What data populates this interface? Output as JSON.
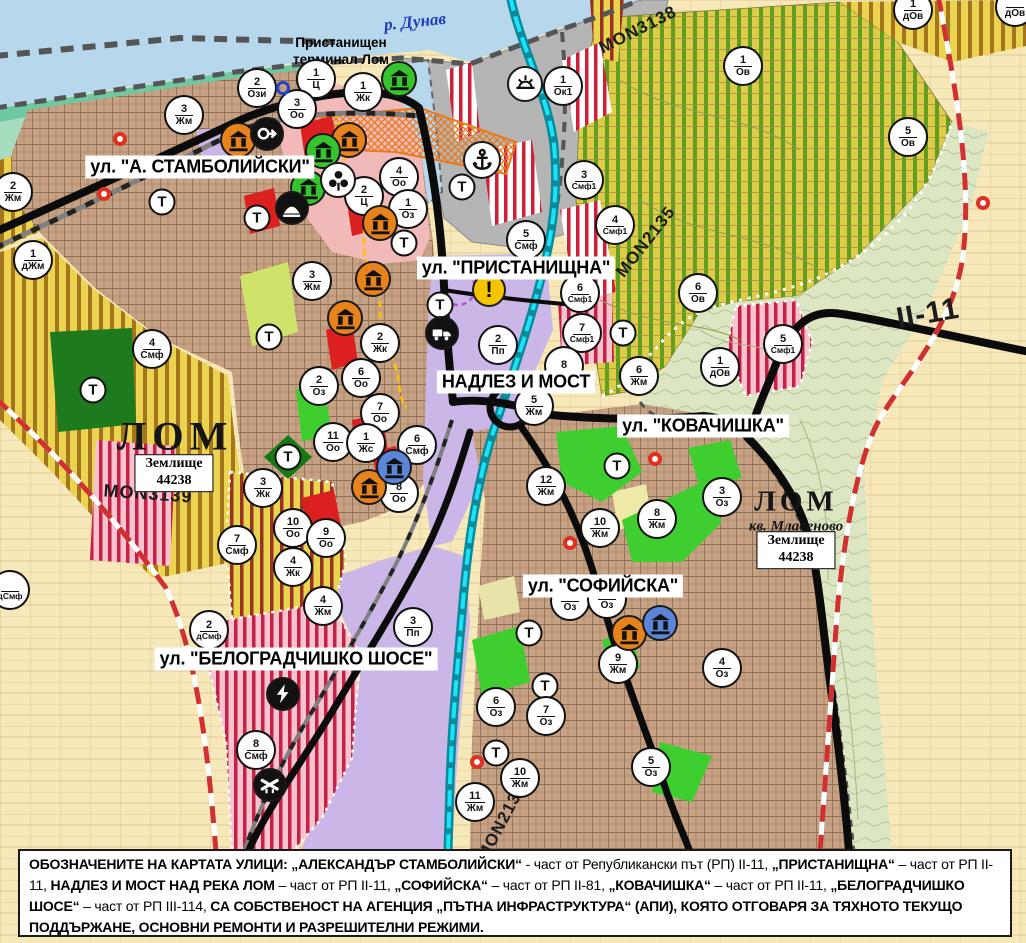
{
  "map": {
    "street_labels": [
      {
        "text": "ул. \"А. СТАМБОЛИЙСКИ\"",
        "x": 200,
        "y": 167
      },
      {
        "text": "ул. \"ПРИСТАНИЩНА\"",
        "x": 516,
        "y": 268
      },
      {
        "text": "НАДЛЕЗ И МОСТ",
        "x": 516,
        "y": 382
      },
      {
        "text": "ул. \"КОВАЧИШКА\"",
        "x": 703,
        "y": 426
      },
      {
        "text": "ул. \"СОФИЙСКА\"",
        "x": 603,
        "y": 586
      },
      {
        "text": "ул. \"БЕЛОГРАДЧИШКО ШОСЕ\"",
        "x": 296,
        "y": 659
      }
    ],
    "river_label": {
      "text": "р. Дунав",
      "x": 415,
      "y": 22,
      "rot": -6
    },
    "terminal_label": {
      "text": "Пристанищен\nтерминал Лом",
      "x": 341,
      "y": 52
    },
    "town_labels": [
      {
        "text": "ЛОМ",
        "x": 175,
        "y": 436,
        "cls": "town-label-lg"
      },
      {
        "text": "ЛОМ",
        "x": 796,
        "y": 502,
        "cls": "town-label-md"
      },
      {
        "text": "кв. Младеново",
        "x": 796,
        "y": 527,
        "cls": "quarter-label"
      }
    ],
    "land_boxes": [
      {
        "line1": "Землище",
        "line2": "44238",
        "x": 174,
        "y": 473
      },
      {
        "line1": "Землище",
        "line2": "44238",
        "x": 796,
        "y": 550
      }
    ],
    "road_labels": [
      {
        "text": "MON3138",
        "x": 638,
        "y": 30,
        "rot": -27,
        "size": 17
      },
      {
        "text": "MON2135",
        "x": 646,
        "y": 242,
        "rot": -52,
        "size": 17
      },
      {
        "text": "II-11",
        "x": 928,
        "y": 314,
        "rot": -10,
        "size": 30
      },
      {
        "text": "MON3139",
        "x": 148,
        "y": 494,
        "rot": 4,
        "size": 18
      },
      {
        "text": "MON2136",
        "x": 502,
        "y": 822,
        "rot": -62,
        "size": 17
      }
    ],
    "t_label": "Т",
    "t_markers": [
      {
        "x": 162,
        "y": 202
      },
      {
        "x": 257,
        "y": 218
      },
      {
        "x": 404,
        "y": 243
      },
      {
        "x": 462,
        "y": 187
      },
      {
        "x": 269,
        "y": 337
      },
      {
        "x": 440,
        "y": 305
      },
      {
        "x": 623,
        "y": 333
      },
      {
        "x": 288,
        "y": 457
      },
      {
        "x": 93,
        "y": 390
      },
      {
        "x": 617,
        "y": 466
      },
      {
        "x": 529,
        "y": 633
      },
      {
        "x": 545,
        "y": 686
      },
      {
        "x": 496,
        "y": 753
      }
    ],
    "zone_markers": [
      {
        "n": "2",
        "c": "Ози",
        "x": 257,
        "y": 88
      },
      {
        "n": "1",
        "c": "Ц",
        "x": 316,
        "y": 79
      },
      {
        "n": "1",
        "c": "Жк",
        "x": 363,
        "y": 92
      },
      {
        "n": "3",
        "c": "Оо",
        "x": 297,
        "y": 109
      },
      {
        "n": "3",
        "c": "Жм",
        "x": 184,
        "y": 115
      },
      {
        "n": "2",
        "c": "Жм",
        "x": 13,
        "y": 192
      },
      {
        "n": "1",
        "c": "дЖм",
        "x": 33,
        "y": 260
      },
      {
        "n": "3",
        "c": "Жм",
        "x": 312,
        "y": 281
      },
      {
        "n": "4",
        "c": "Оо",
        "x": 399,
        "y": 177
      },
      {
        "n": "2",
        "c": "Ц",
        "x": 364,
        "y": 196
      },
      {
        "n": "1",
        "c": "Оз",
        "x": 408,
        "y": 209
      },
      {
        "n": "1",
        "c": "Ок1",
        "x": 563,
        "y": 86
      },
      {
        "n": "1",
        "c": "Ов",
        "x": 743,
        "y": 66
      },
      {
        "n": "5",
        "c": "Ов",
        "x": 908,
        "y": 137
      },
      {
        "n": "1",
        "c": "дОв",
        "x": 913,
        "y": 10
      },
      {
        "n": "",
        "c": "дОв",
        "x": 1015,
        "y": 7
      },
      {
        "n": "3",
        "c": "Смф1",
        "x": 584,
        "y": 180
      },
      {
        "n": "4",
        "c": "Смф1",
        "x": 615,
        "y": 225
      },
      {
        "n": "6",
        "c": "Ов",
        "x": 698,
        "y": 293
      },
      {
        "n": "5",
        "c": "Смф1",
        "x": 783,
        "y": 344
      },
      {
        "n": "1",
        "c": "дОв",
        "x": 720,
        "y": 367
      },
      {
        "n": "5",
        "c": "Смф",
        "x": 526,
        "y": 240
      },
      {
        "n": "6",
        "c": "Смф1",
        "x": 580,
        "y": 293
      },
      {
        "n": "7",
        "c": "Смф1",
        "x": 582,
        "y": 333
      },
      {
        "n": "2",
        "c": "Пп",
        "x": 498,
        "y": 345
      },
      {
        "n": "8",
        "c": "",
        "x": 564,
        "y": 366
      },
      {
        "n": "6",
        "c": "Жм",
        "x": 639,
        "y": 376
      },
      {
        "n": "5",
        "c": "Жм",
        "x": 534,
        "y": 406
      },
      {
        "n": "12",
        "c": "Жм",
        "x": 546,
        "y": 486
      },
      {
        "n": "10",
        "c": "Жм",
        "x": 600,
        "y": 528
      },
      {
        "n": "8",
        "c": "Жм",
        "x": 657,
        "y": 519
      },
      {
        "n": "3",
        "c": "Оз",
        "x": 722,
        "y": 497
      },
      {
        "n": "",
        "c": "Оз",
        "x": 570,
        "y": 601
      },
      {
        "n": "",
        "c": "Оз",
        "x": 607,
        "y": 599
      },
      {
        "n": "9",
        "c": "Жм",
        "x": 618,
        "y": 664
      },
      {
        "n": "4",
        "c": "Оз",
        "x": 722,
        "y": 668
      },
      {
        "n": "6",
        "c": "Оз",
        "x": 496,
        "y": 707
      },
      {
        "n": "7",
        "c": "Оз",
        "x": 546,
        "y": 716
      },
      {
        "n": "5",
        "c": "Оз",
        "x": 651,
        "y": 767
      },
      {
        "n": "10",
        "c": "Жм",
        "x": 520,
        "y": 778
      },
      {
        "n": "11",
        "c": "Жм",
        "x": 475,
        "y": 802
      },
      {
        "n": "3",
        "c": "Пп",
        "x": 413,
        "y": 627
      },
      {
        "n": "2",
        "c": "дСмф",
        "x": 209,
        "y": 630
      },
      {
        "n": "7",
        "c": "Смф",
        "x": 237,
        "y": 545
      },
      {
        "n": "10",
        "c": "Оо",
        "x": 293,
        "y": 528
      },
      {
        "n": "9",
        "c": "Оо",
        "x": 326,
        "y": 538
      },
      {
        "n": "4",
        "c": "Жк",
        "x": 293,
        "y": 567
      },
      {
        "n": "4",
        "c": "Жм",
        "x": 323,
        "y": 606
      },
      {
        "n": "8",
        "c": "Смф",
        "x": 256,
        "y": 750
      },
      {
        "n": "3",
        "c": "Жк",
        "x": 263,
        "y": 488
      },
      {
        "n": "2",
        "c": "Жк",
        "x": 380,
        "y": 343
      },
      {
        "n": "2",
        "c": "Оз",
        "x": 319,
        "y": 386
      },
      {
        "n": "6",
        "c": "Оо",
        "x": 361,
        "y": 378
      },
      {
        "n": "7",
        "c": "Оо",
        "x": 380,
        "y": 413
      },
      {
        "n": "11",
        "c": "Оо",
        "x": 333,
        "y": 442
      },
      {
        "n": "1",
        "c": "Жс",
        "x": 366,
        "y": 443
      },
      {
        "n": "6",
        "c": "Смф",
        "x": 417,
        "y": 445
      },
      {
        "n": "8",
        "c": "Оо",
        "x": 399,
        "y": 493
      },
      {
        "n": "4",
        "c": "Смф",
        "x": 152,
        "y": 349
      },
      {
        "n": "",
        "c": "дСмф",
        "x": 10,
        "y": 590
      }
    ],
    "icon_markers": [
      {
        "type": "monument-orange",
        "x": 238,
        "y": 140
      },
      {
        "type": "monument-orange",
        "x": 349,
        "y": 140
      },
      {
        "type": "monument-orange",
        "x": 380,
        "y": 223
      },
      {
        "type": "monument-orange",
        "x": 373,
        "y": 279
      },
      {
        "type": "monument-orange",
        "x": 345,
        "y": 318
      },
      {
        "type": "monument-orange",
        "x": 369,
        "y": 487
      },
      {
        "type": "monument-orange",
        "x": 629,
        "y": 633
      },
      {
        "type": "monument-green",
        "x": 399,
        "y": 79
      },
      {
        "type": "monument-green",
        "x": 323,
        "y": 151
      },
      {
        "type": "monument-green",
        "x": 308,
        "y": 188
      },
      {
        "type": "monument-blue",
        "x": 394,
        "y": 467
      },
      {
        "type": "monument-blue",
        "x": 660,
        "y": 623
      },
      {
        "type": "trefoil",
        "x": 338,
        "y": 180
      },
      {
        "type": "direction-arrow",
        "x": 267,
        "y": 134
      },
      {
        "type": "tunnel",
        "x": 292,
        "y": 208
      },
      {
        "type": "sun",
        "x": 525,
        "y": 84
      },
      {
        "type": "anchor",
        "x": 482,
        "y": 160
      },
      {
        "type": "warning",
        "x": 489,
        "y": 290
      },
      {
        "type": "truck",
        "x": 442,
        "y": 333
      },
      {
        "type": "lightning",
        "x": 283,
        "y": 694
      },
      {
        "type": "rail-crossing",
        "x": 270,
        "y": 785
      },
      {
        "type": "red-dot",
        "x": 120,
        "y": 139
      },
      {
        "type": "red-dot",
        "x": 104,
        "y": 194
      },
      {
        "type": "red-dot",
        "x": 655,
        "y": 459
      },
      {
        "type": "red-dot",
        "x": 570,
        "y": 543
      },
      {
        "type": "red-dot",
        "x": 477,
        "y": 762
      },
      {
        "type": "red-dot",
        "x": 983,
        "y": 203
      },
      {
        "type": "blue-ring",
        "x": 283,
        "y": 88
      }
    ],
    "warning_glyph": "!"
  },
  "footer": {
    "segments": [
      {
        "b": true,
        "t": "ОБОЗНАЧЕНИТЕ НА КАРТАТА УЛИЦИ: „АЛЕКСАНДЪР СТАМБОЛИЙСКИ“"
      },
      {
        "b": false,
        "t": " - част от Републикански път (РП) II-11, "
      },
      {
        "b": true,
        "t": "„ПРИСТАНИЩНА“"
      },
      {
        "b": false,
        "t": " – част от РП II-11, "
      },
      {
        "b": true,
        "t": "НАДЛЕЗ И МОСТ НАД РЕКА ЛОМ"
      },
      {
        "b": false,
        "t": " – част от РП II-11, "
      },
      {
        "b": true,
        "t": "„СОФИЙСКА“"
      },
      {
        "b": false,
        "t": " – част от РП II-81, "
      },
      {
        "b": true,
        "t": "„КОВАЧИШКА“"
      },
      {
        "b": false,
        "t": " – част от РП II-11, "
      },
      {
        "b": true,
        "t": "„БЕЛОГРАДЧИШКО ШОСЕ“"
      },
      {
        "b": false,
        "t": " – част от РП III-114, "
      },
      {
        "b": true,
        "t": "СА СОБСТВЕНОСТ НА АГЕНЦИЯ „ПЪТНА ИНФРАСТРУКТУРА“ (АПИ), КОЯТО ОТГОВАРЯ ЗА ТЯХНОТО ТЕКУЩО ПОДДЪРЖАНЕ, ОСНОВНИ РЕМОНТИ И РАЗРЕШИТЕЛНИ РЕЖИМИ."
      }
    ]
  },
  "colors": {
    "river": "#b6d7ec",
    "port": "#b5b5b5",
    "urban": "#c7a183",
    "lavender": "#cbb7e7",
    "pink_zone": "#f2b9b9",
    "bright_green": "#3fce2f",
    "dark_green": "#1d7a1d",
    "red_patch": "#dc1f1f",
    "cyan_channel": "#19e4fa",
    "boundary_red": "#d03030",
    "monument_orange": "#e8831c",
    "monument_green": "#35c42e",
    "monument_blue": "#5b85d6",
    "warning_yellow": "#f5c400"
  }
}
